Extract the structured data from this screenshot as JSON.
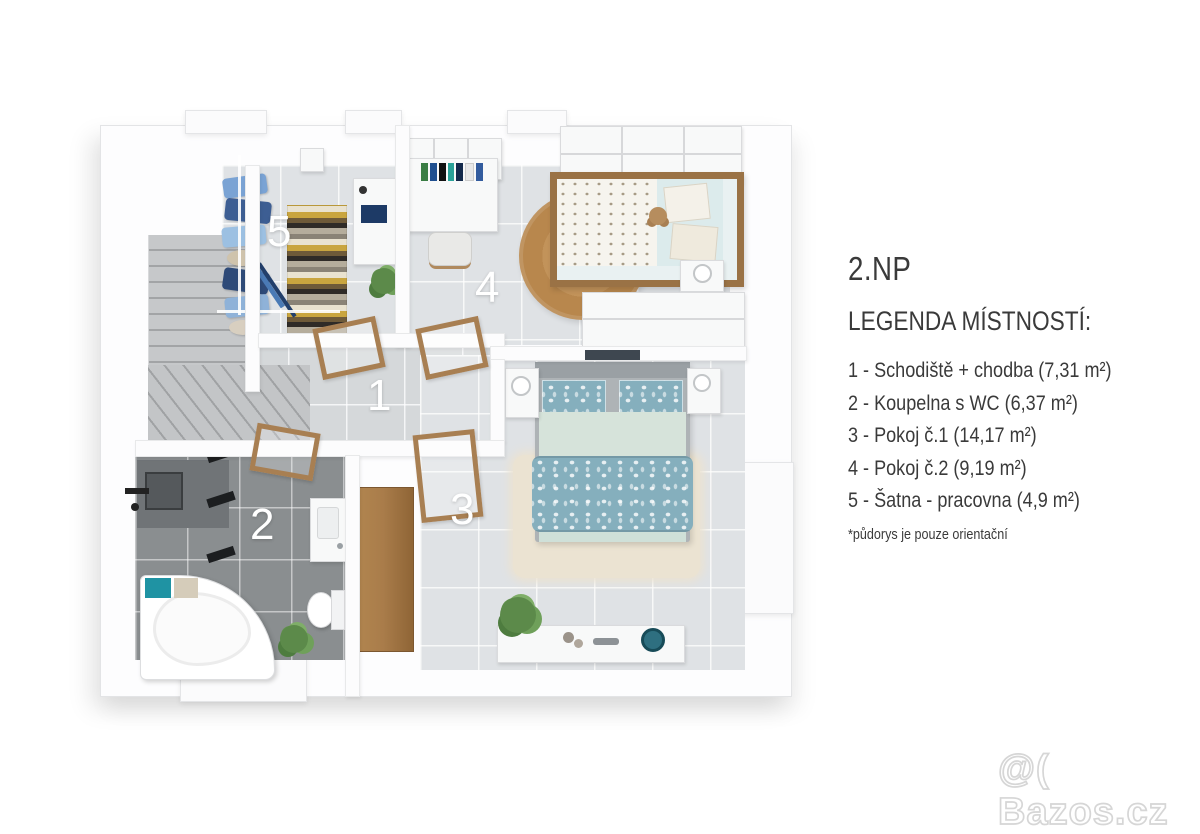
{
  "floor_title": "2.NP",
  "legend": {
    "heading": "LEGENDA MÍSTNOSTÍ:",
    "items": [
      "1 - Schodiště + chodba (7,31 m²)",
      "2 - Koupelna s WC (6,37 m²)",
      "3 - Pokoj č.1 (14,17 m²)",
      "4 - Pokoj č.2 (9,19 m²)",
      "5 - Šatna - pracovna (4,9 m²)"
    ],
    "footnote": "*půdorys je pouze orientační"
  },
  "floorplan": {
    "room_labels": {
      "hallway": "1",
      "bathroom": "2",
      "bedroom1": "3",
      "bedroom2": "4",
      "closet": "5"
    }
  },
  "watermark": "@( Bazos.cz",
  "colors": {
    "wood": "#a87f52",
    "teal_bedding": "#85afbd",
    "bathroom_tile": "#8a8e90",
    "light_floor_tile": "#dfe2e5",
    "hall_tile": "#d5d8da",
    "stairs": "#bdbfc1",
    "rug_cream": "#ebe3d2",
    "rug_jute": "#c2935a",
    "text": "#3a3a3a",
    "watermark_outline": "#d6d6d6"
  }
}
